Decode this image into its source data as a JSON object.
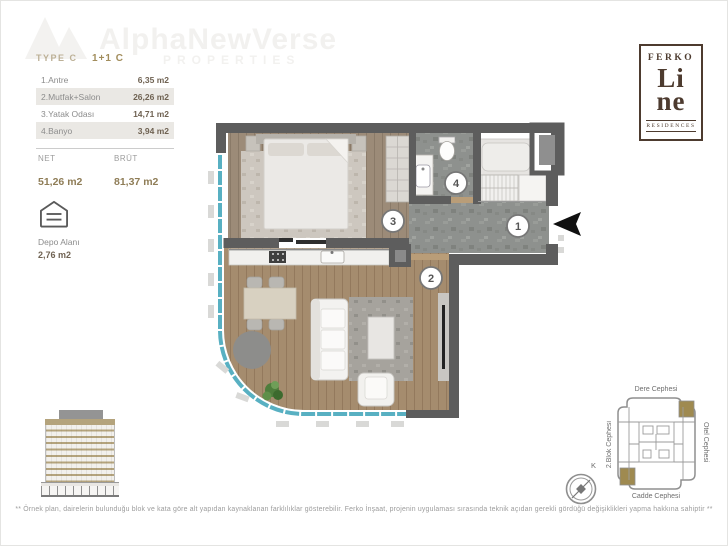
{
  "watermark": {
    "brand": "AlphaNewVerse",
    "sub": "PROPERTIES"
  },
  "unit_info": {
    "type_label": "TYPE C",
    "type_value": "1+1 C",
    "rooms": [
      {
        "name": "1.Antre",
        "area": "6,35 m2"
      },
      {
        "name": "2.Mutfak+Salon",
        "area": "26,26 m2"
      },
      {
        "name": "3.Yatak Odası",
        "area": "14,71 m2"
      },
      {
        "name": "4.Banyo",
        "area": "3,94 m2"
      }
    ],
    "net_label": "NET",
    "net_value": "51,26 m2",
    "brut_label": "BRÜT",
    "brut_value": "81,37 m2",
    "storage_label": "Depo Alanı",
    "storage_value": "2,76 m2"
  },
  "logo": {
    "top": "FERKO",
    "line1": "Li",
    "line2": "ne",
    "bottom": "RESIDENCES"
  },
  "floor_plan": {
    "numbers": {
      "n1": "1",
      "n2": "2",
      "n3": "3",
      "n4": "4"
    },
    "entry_marker": "entry-arrow"
  },
  "site_plan": {
    "labels": {
      "top": "Dere Cephesi",
      "right": "Otel Cephesi",
      "left": "2.Blok Cephesi",
      "bottom": "Cadde Cephesi"
    },
    "compass_label": "K",
    "highlight_color": "#9f8a50"
  },
  "footer": {
    "disclaimer": "** Örnek plan, dairelerin bulunduğu blok ve kata göre alt yapıdan kaynaklanan farklılıklar gösterebilir. Ferko İnşaat, projenin uygulaması sırasında teknik açıdan gerekli gördüğü değişiklikleri yapma hakkına sahiptir **"
  },
  "colors": {
    "accent_tan": "#a28d5c",
    "logo_brown": "#4d3b2f",
    "balcony_glass": "#58b0c2",
    "wall": "#5d5d5d"
  }
}
